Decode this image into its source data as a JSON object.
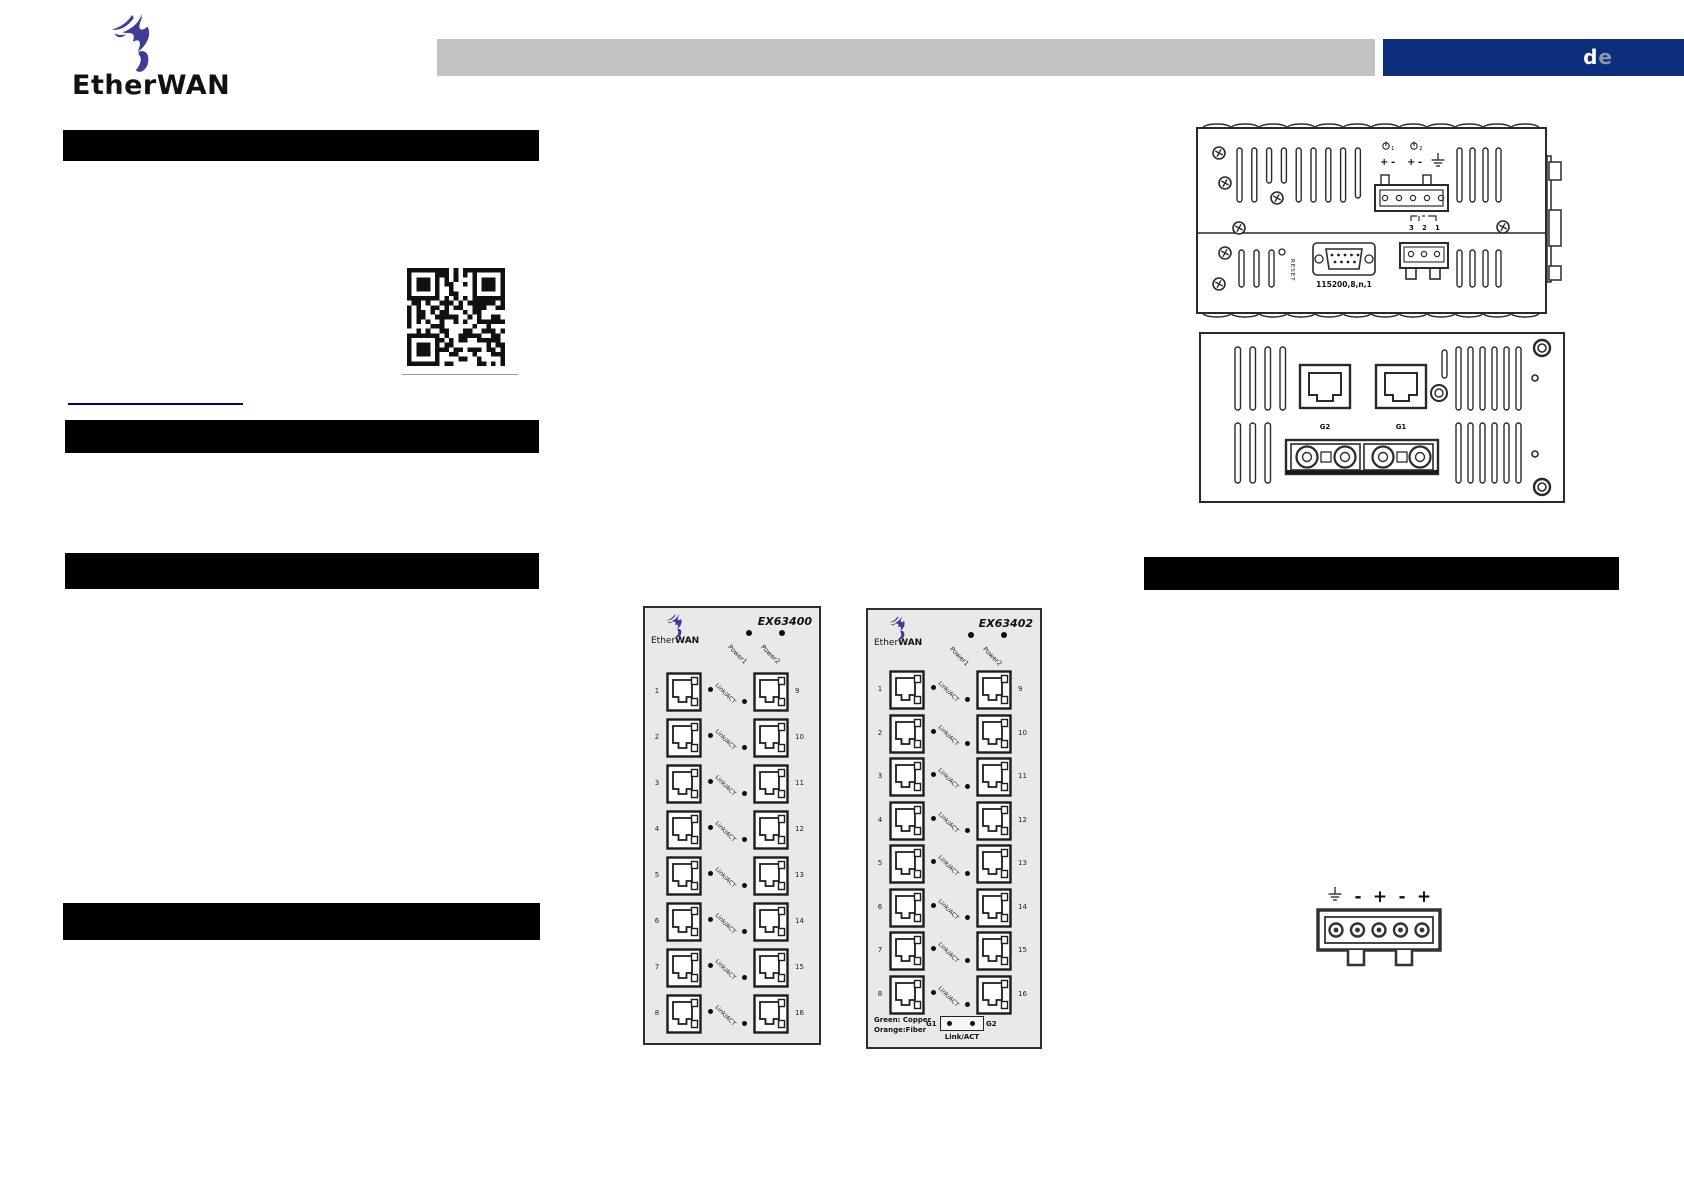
{
  "header": {
    "brand": {
      "ether": "Ether",
      "wan": "WAN"
    },
    "lang": {
      "d": "d",
      "e": "e"
    }
  },
  "top_view": {
    "power1_num": "1",
    "power2_num": "2",
    "signs": [
      "+",
      "-",
      "+",
      "-"
    ],
    "relay_pins": [
      "3",
      "2",
      "1"
    ],
    "reset_label": "RESET",
    "serial_label": "115200,8,n,1"
  },
  "rear_view": {
    "left_port_label": "G2",
    "right_port_label": "G1"
  },
  "terminal": {
    "signs": [
      "-",
      "+",
      "-",
      "+"
    ]
  },
  "panels": [
    {
      "model": "EX63400",
      "brand_ether": "Ether",
      "brand_wan": "WAN",
      "power_labels": [
        "Power1",
        "Power2"
      ],
      "link_label": "Link/ACT",
      "left_ports": [
        "1",
        "2",
        "3",
        "4",
        "5",
        "6",
        "7",
        "8"
      ],
      "right_ports": [
        "9",
        "10",
        "11",
        "12",
        "13",
        "14",
        "15",
        "16"
      ]
    },
    {
      "model": "EX63402",
      "brand_ether": "Ether",
      "brand_wan": "WAN",
      "power_labels": [
        "Power1",
        "Power2"
      ],
      "link_label": "Link/ACT",
      "left_ports": [
        "1",
        "2",
        "3",
        "4",
        "5",
        "6",
        "7",
        "8"
      ],
      "right_ports": [
        "9",
        "10",
        "11",
        "12",
        "13",
        "14",
        "15",
        "16"
      ],
      "legend": {
        "line1": "Green:  Copper",
        "line2": "Orange:Fiber",
        "g1": "G1",
        "g2": "G2",
        "link": "Link/ACT"
      }
    }
  ]
}
